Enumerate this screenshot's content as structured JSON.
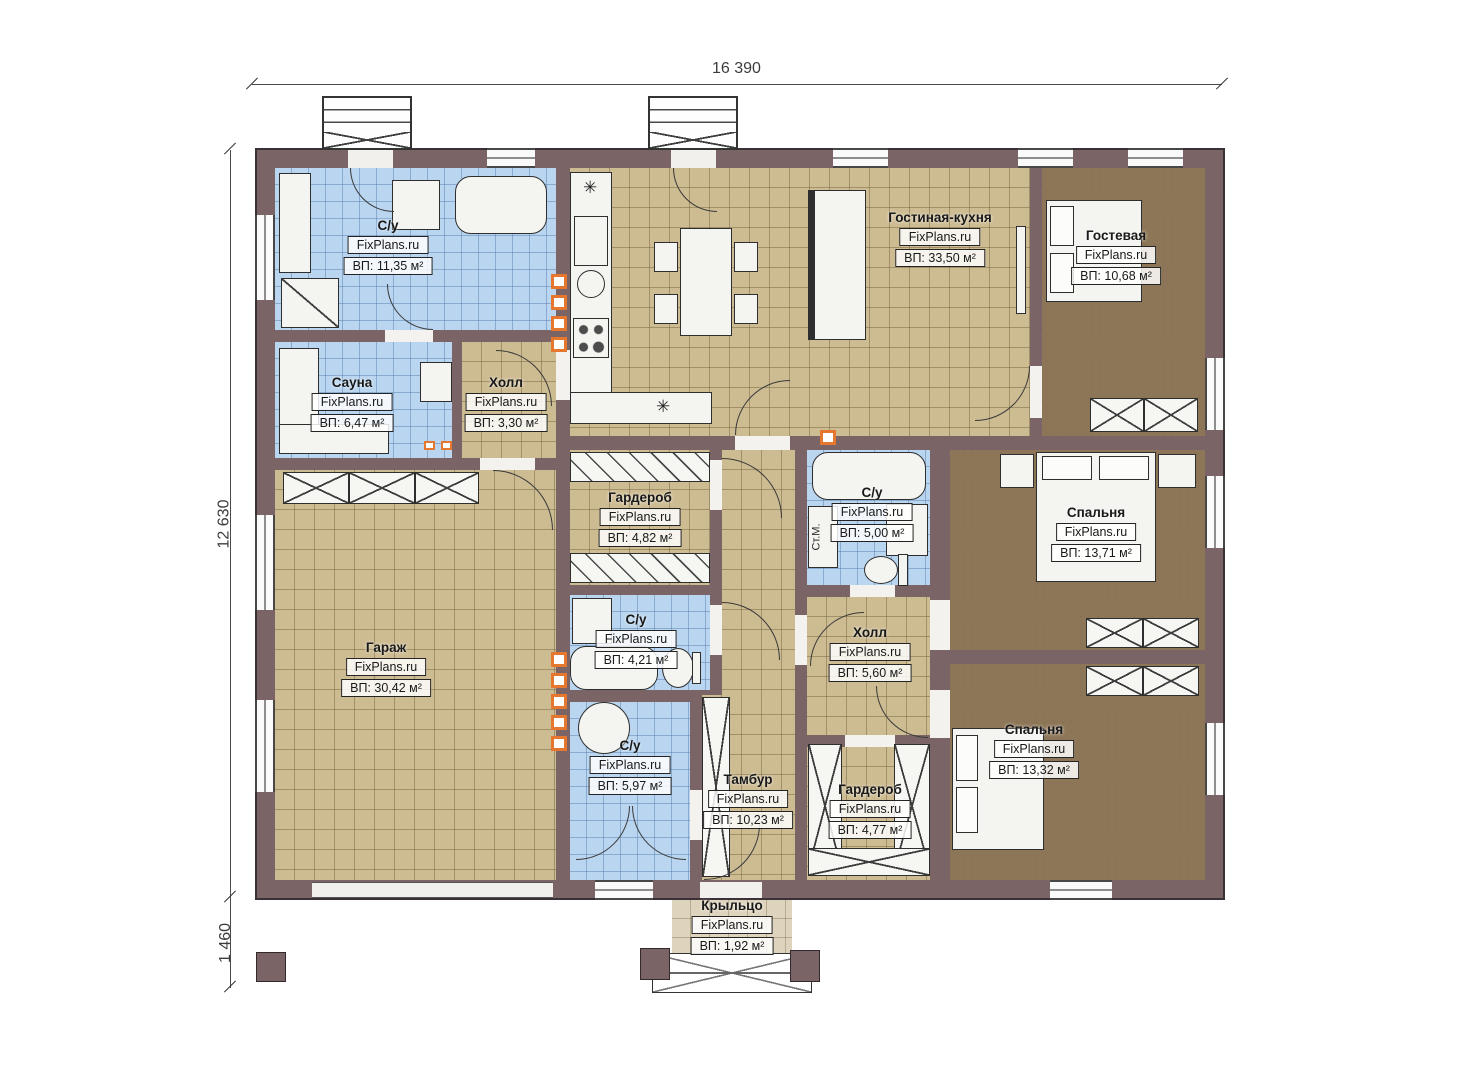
{
  "watermark": "FixPlans.ru",
  "dimensions": {
    "total_width": "16 390",
    "total_height": "12 630",
    "porch_depth": "1 460"
  },
  "appliance_labels": {
    "washing_machine": "Ст.М."
  },
  "vent_symbol": "✳",
  "rooms": [
    {
      "name": "С/у",
      "area": "ВП: 11,35 м²"
    },
    {
      "name": "Сауна",
      "area": "ВП: 6,47 м²"
    },
    {
      "name": "Холл",
      "area": "ВП: 3,30 м²"
    },
    {
      "name": "Гостиная-кухня",
      "area": "ВП: 33,50 м²"
    },
    {
      "name": "Гостевая",
      "area": "ВП: 10,68 м²"
    },
    {
      "name": "Гардероб",
      "area": "ВП: 4,82 м²"
    },
    {
      "name": "С/у",
      "area": "ВП: 5,00 м²"
    },
    {
      "name": "Спальня",
      "area": "ВП: 13,71 м²"
    },
    {
      "name": "Гараж",
      "area": "ВП: 30,42 м²"
    },
    {
      "name": "С/у",
      "area": "ВП: 4,21 м²"
    },
    {
      "name": "Холл",
      "area": "ВП: 5,60 м²"
    },
    {
      "name": "С/у",
      "area": "ВП: 5,97 м²"
    },
    {
      "name": "Тамбур",
      "area": "ВП: 10,23 м²"
    },
    {
      "name": "Гардероб",
      "area": "ВП: 4,77 м²"
    },
    {
      "name": "Спальня",
      "area": "ВП: 13,32 м²"
    },
    {
      "name": "Крыльцо",
      "area": "ВП: 1,92 м²"
    }
  ],
  "colors": {
    "wall": "#7a6466",
    "floor_tile": "#cdbb92",
    "floor_carpet": "#8d7658",
    "floor_wet": "#b9d5ef",
    "floor_porch": "#ded3bc",
    "vent_accent": "#e6772e"
  }
}
